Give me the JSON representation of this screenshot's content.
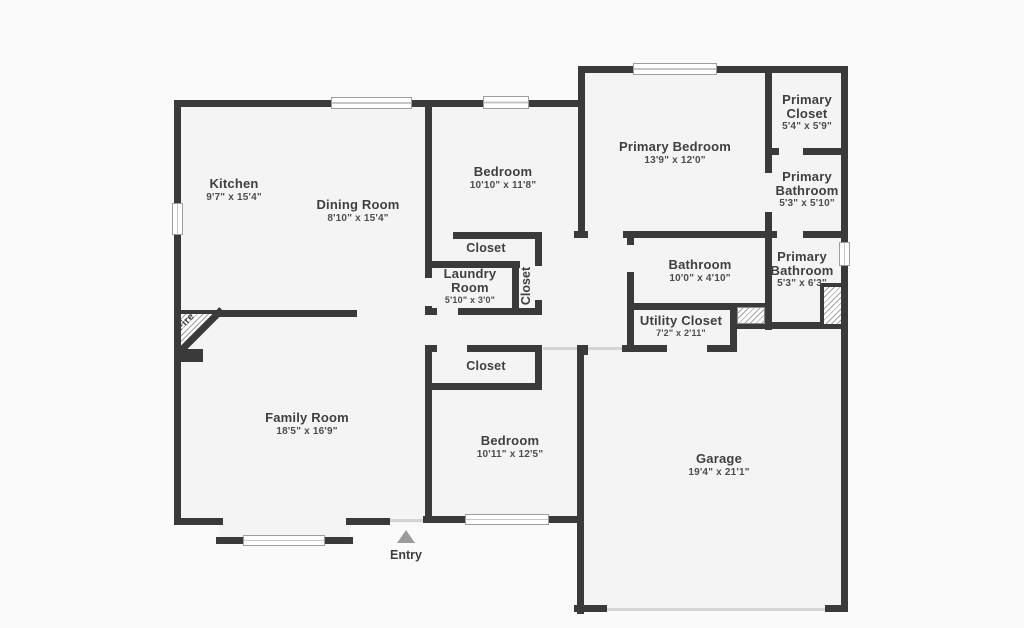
{
  "rooms": {
    "kitchen": {
      "name": "Kitchen",
      "dims": "9'7\" x 15'4\""
    },
    "dining_room": {
      "name": "Dining Room",
      "dims": "8'10\" x 15'4\""
    },
    "bedroom_top": {
      "name": "Bedroom",
      "dims": "10'10\" x 11'8\""
    },
    "primary_bedroom": {
      "name": "Primary Bedroom",
      "dims": "13'9\" x 12'0\""
    },
    "primary_closet": {
      "name": "Primary Closet",
      "dims": "5'4\" x 5'9\""
    },
    "primary_bathroom_upper": {
      "name": "Primary Bathroom",
      "dims": "5'3\" x 5'10\""
    },
    "closet_hall_top": {
      "name": "Closet"
    },
    "laundry_room": {
      "name": "Laundry Room",
      "dims": "5'10\" x 3'0\""
    },
    "closet_vertical": {
      "name": "Closet"
    },
    "bathroom": {
      "name": "Bathroom",
      "dims": "10'0\" x 4'10\""
    },
    "primary_bathroom_lower": {
      "name": "Primary Bathroom",
      "dims": "5'3\" x 6'3\""
    },
    "utility_closet": {
      "name": "Utility Closet",
      "dims": "7'2\" x 2'11\""
    },
    "closet_bedroom2": {
      "name": "Closet"
    },
    "family_room": {
      "name": "Family Room",
      "dims": "18'5\" x 16'9\""
    },
    "bedroom_bottom": {
      "name": "Bedroom",
      "dims": "10'11\" x 12'5\""
    },
    "garage": {
      "name": "Garage",
      "dims": "19'4\" x 21'1\""
    }
  },
  "annotations": {
    "entry": "Entry",
    "fireplace": "Fire"
  },
  "colors": {
    "wall": "#3a3a3a",
    "floor": "#f4f4f4",
    "background": "#fafafa",
    "text": "#3f3f3f"
  }
}
